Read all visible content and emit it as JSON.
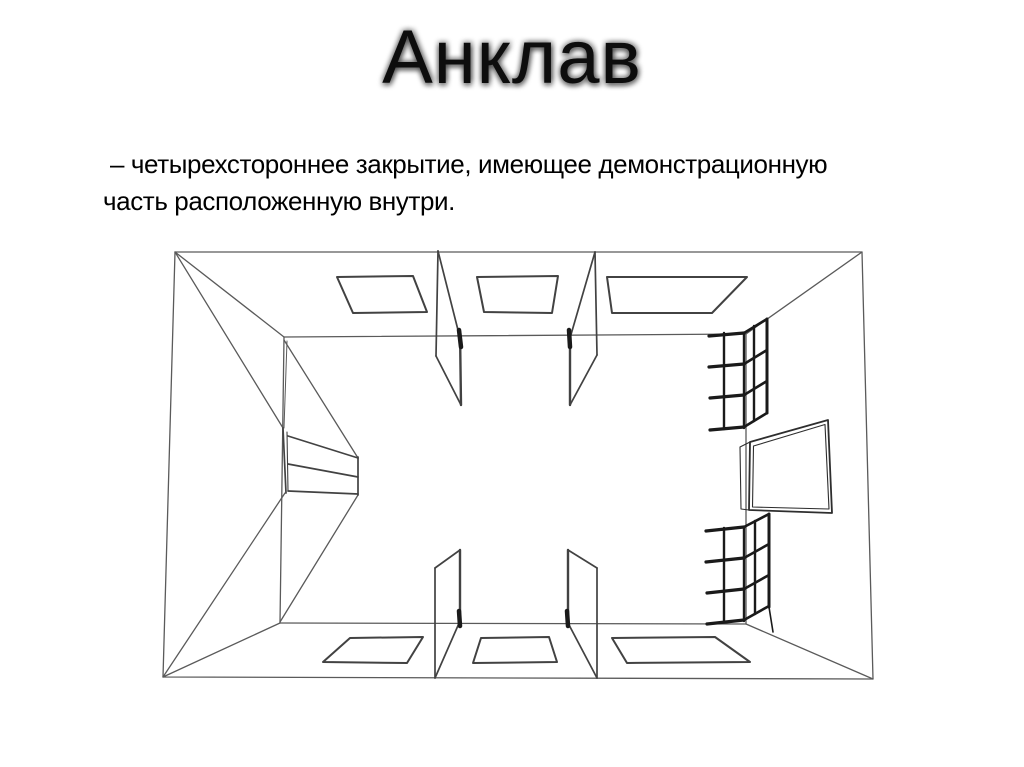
{
  "slide": {
    "title": "Анклав",
    "definition": {
      "line1": "– четырехстороннее закрытие, имеющее демонстрационную",
      "line2": "часть расположенную внутри."
    }
  },
  "diagram": {
    "label": "enclave-booth-wireframe",
    "stroke_thin": "#5a5a5a",
    "stroke_medium": "#424242",
    "stroke_dark": "#1a1a1a",
    "stroke_screen": "#2e2e2e"
  },
  "colors": {
    "background": "#ffffff",
    "title_text": "#0d0d0d",
    "body_text": "#000000"
  }
}
